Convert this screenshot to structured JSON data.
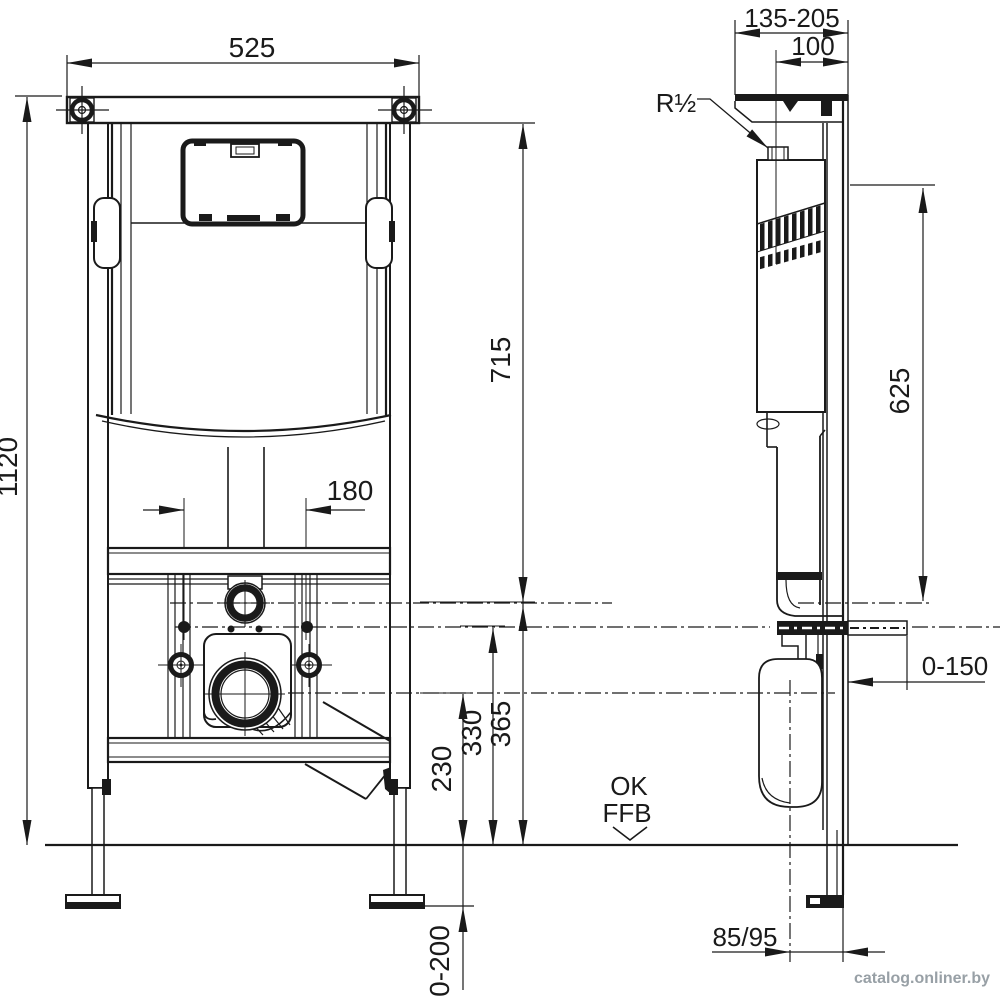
{
  "title": "Concealed WC cistern installation frame - technical dimension drawing",
  "front_view": {
    "width_top": "525",
    "height_total": "1120",
    "stud_spacing": "180",
    "dim_top_to_supply": "715",
    "dim_supply_height": "365",
    "dim_stud_height": "330",
    "dim_outlet_height": "230",
    "dim_leg_adjust": "0-200"
  },
  "side_view": {
    "depth_range": "135-205",
    "dim_supply_depth": "100",
    "supply_thread": "R½",
    "dim_625": "625",
    "dim_bracket_adjust": "0-150",
    "dim_outlet_offset": "85/95"
  },
  "floor": {
    "label_line1": "OK",
    "label_line2": "FFB"
  },
  "watermark": "catalog.onliner.by"
}
